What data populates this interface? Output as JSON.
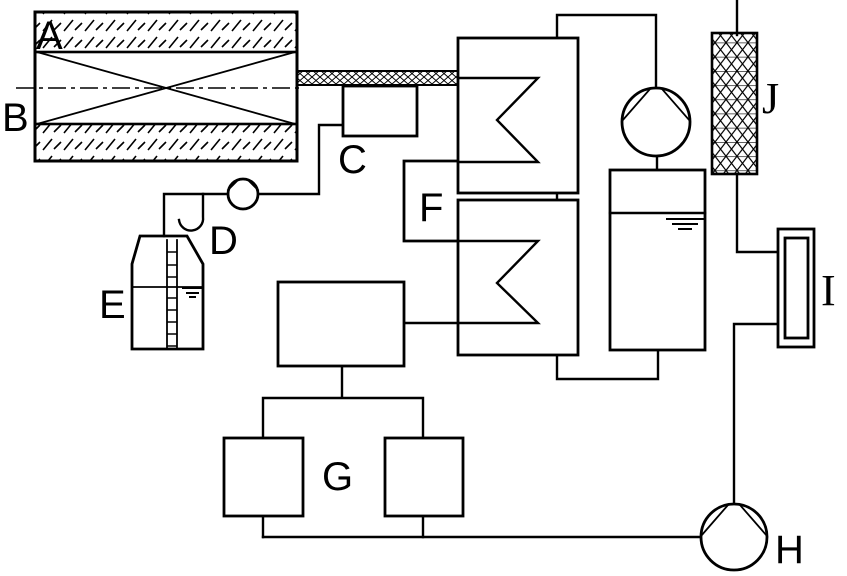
{
  "colors": {
    "background": "#ffffff",
    "line": "#000000"
  },
  "labels": {
    "A": "A",
    "B": "B",
    "C": "C",
    "D": "D",
    "E": "E",
    "F": "F",
    "G": "G",
    "H": "H",
    "I": "I",
    "J": "J"
  }
}
